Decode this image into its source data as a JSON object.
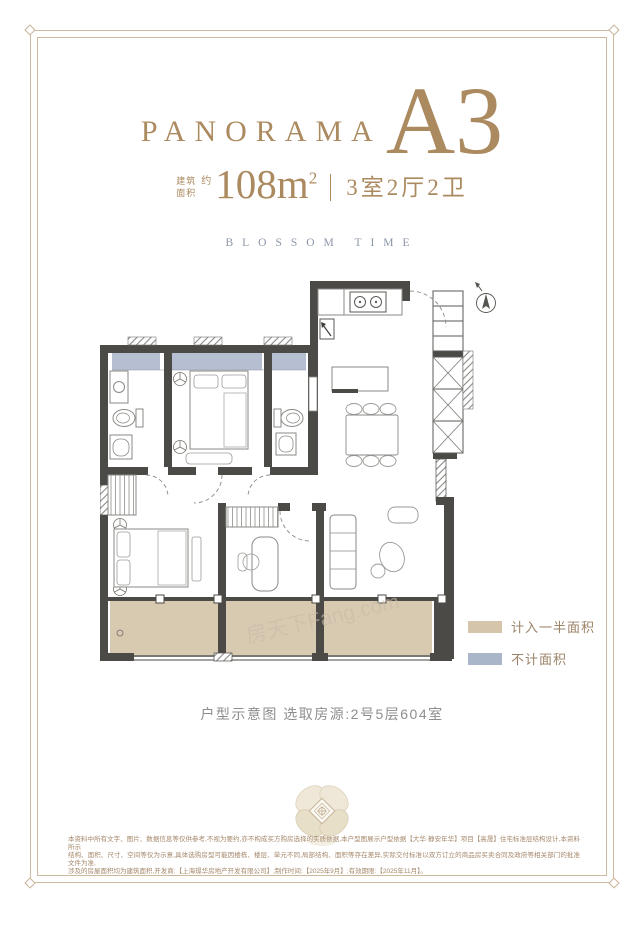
{
  "header": {
    "brand": "PANORAMA",
    "unit": "A3",
    "area_prefix_l1": "建筑",
    "area_prefix_l2": "面积",
    "approx": "约",
    "area_value": "108m",
    "area_exp": "2",
    "spec": "3室2厅2卫",
    "subtitle": "BLOSSOM TIME"
  },
  "legend": {
    "items": [
      {
        "label": "计入一半面积",
        "color": "#d4c5ab"
      },
      {
        "label": "不计面积",
        "color": "#a9b5c9"
      }
    ]
  },
  "caption": {
    "text": "户型示意图 选取房源:2号5层604室"
  },
  "floorplan": {
    "watermark": "房天下Fang.com",
    "compass": "north-indicator"
  },
  "disclaimer": {
    "lines": [
      "本资料中所有文字、图片、数据信息等仅供参考,不视为要约,亦不构成买方购房选择的实质依据,本户型图展示户型依据【大华·静安年华】项目【高晟】住宅标准层结构设计,本资料所示",
      "结构、面积、尺寸、空间等仅为示意,具体选购房型可能因楼栋、楼层、单元不同,局部结构、面积等存在差异,实际交付标准以双方订立的商品房买卖合同及政府等相关部门的批准文件为准,",
      "涉及的房屋面积均为建筑面积,开发商:【上海璟华房地产开发有限公司】;制作时间:【2025年9月】;有效期限:【2025年11月】。"
    ]
  },
  "colors": {
    "title_gold": "#ac8a60",
    "frame_gold": "#cdb99e",
    "subtitle_blue": "#8b94a8",
    "wall_dark": "#4b4a46",
    "window_band": "#b5bfd1",
    "balcony_half_area": "#d8c9b1",
    "legend_text": "#9b8266",
    "caption_gray": "#8e8e8e",
    "disclaimer_brown": "#a5876a"
  }
}
